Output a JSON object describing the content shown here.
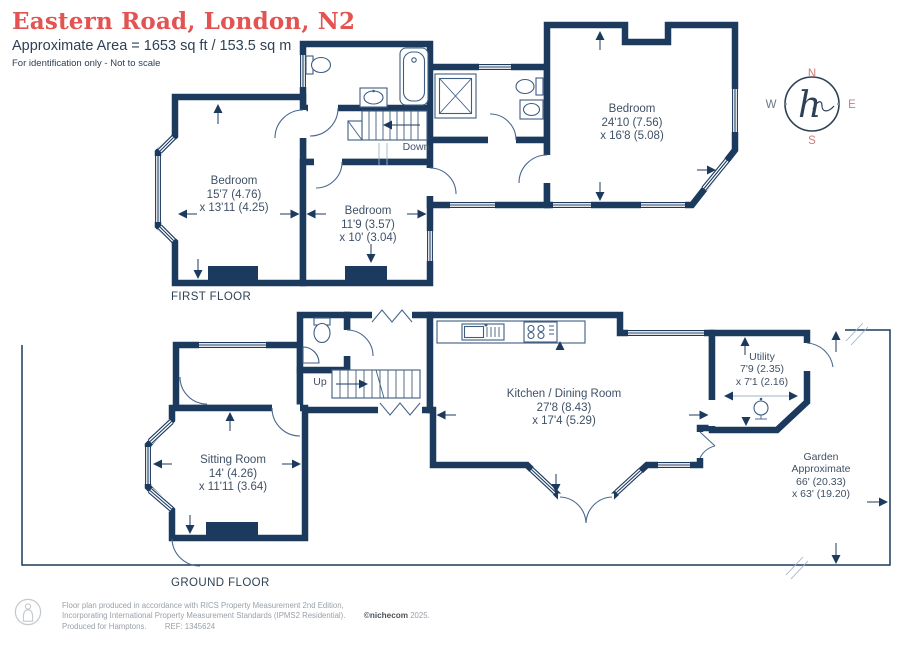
{
  "header": {
    "title": "Eastern Road, London, N2",
    "area": "Approximate Area = 1653 sq ft / 153.5 sq m",
    "disclaimer": "For identification only - Not to scale"
  },
  "compass": {
    "n": "N",
    "e": "E",
    "s": "S",
    "w": "W",
    "monogram": "h"
  },
  "first_floor": {
    "floor_label": "FIRST FLOOR",
    "stairs_label": "Down",
    "bedroom_left": {
      "name": "Bedroom",
      "dim1": "15'7 (4.76)",
      "dim2": "x 13'11 (4.25)"
    },
    "bedroom_mid": {
      "name": "Bedroom",
      "dim1": "11'9 (3.57)",
      "dim2": "x 10' (3.04)"
    },
    "bedroom_main": {
      "name": "Bedroom",
      "dim1": "24'10 (7.56)",
      "dim2": "x 16'8 (5.08)"
    }
  },
  "ground_floor": {
    "floor_label": "GROUND FLOOR",
    "stairs_label": "Up",
    "sitting_room": {
      "name": "Sitting Room",
      "dim1": "14' (4.26)",
      "dim2": "x 11'11 (3.64)"
    },
    "kitchen_dining": {
      "name": "Kitchen / Dining Room",
      "dim1": "27'8 (8.43)",
      "dim2": "x 17'4 (5.29)"
    },
    "utility": {
      "name": "Utility",
      "dim1": "7'9 (2.35)",
      "dim2": "x 7'1 (2.16)"
    },
    "garden": {
      "name": "Garden",
      "qualifier": "Approximate",
      "dim1": "66' (20.33)",
      "dim2": "x 63' (19.20)"
    }
  },
  "footer": {
    "line1": "Floor plan produced in accordance with RICS Property Measurement 2nd Edition,",
    "line2": "Incorporating International Property Measurement Standards (IPMS2 Residential).",
    "copyright": "©nichecom",
    "year": "2025.",
    "produced_for": "Produced for Hamptons.",
    "ref": "REF: 1345624"
  },
  "colors": {
    "wall": "#1c3a5e",
    "accent_red": "#e25352",
    "compass_red": "#d07a7a",
    "label_text": "#3f5166",
    "heading_text": "#2e4154",
    "footer_text": "#9aa1a8",
    "fixture": "#3f5e82"
  }
}
